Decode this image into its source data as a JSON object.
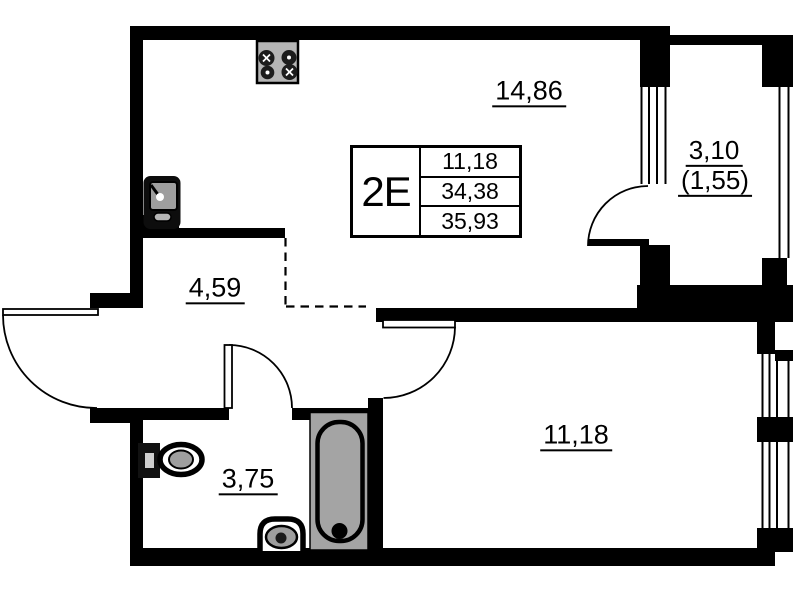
{
  "plan": {
    "title_block": {
      "apartment_type": "2E",
      "values": [
        "11,18",
        "34,38",
        "35,93"
      ]
    },
    "rooms": {
      "kitchen_living": {
        "area": "14,86"
      },
      "hallway": {
        "area": "4,59"
      },
      "bathroom": {
        "area": "3,75"
      },
      "bedroom": {
        "area": "11,18"
      },
      "balcony": {
        "area": "3,10",
        "area_reduced": "(1,55)"
      }
    },
    "fixtures": [
      "stove",
      "kitchen-sink",
      "toilet",
      "washbasin",
      "bathtub"
    ],
    "colors": {
      "wall": "#000000",
      "background": "#ffffff",
      "fixture_gray": "#a4a4a4"
    }
  }
}
